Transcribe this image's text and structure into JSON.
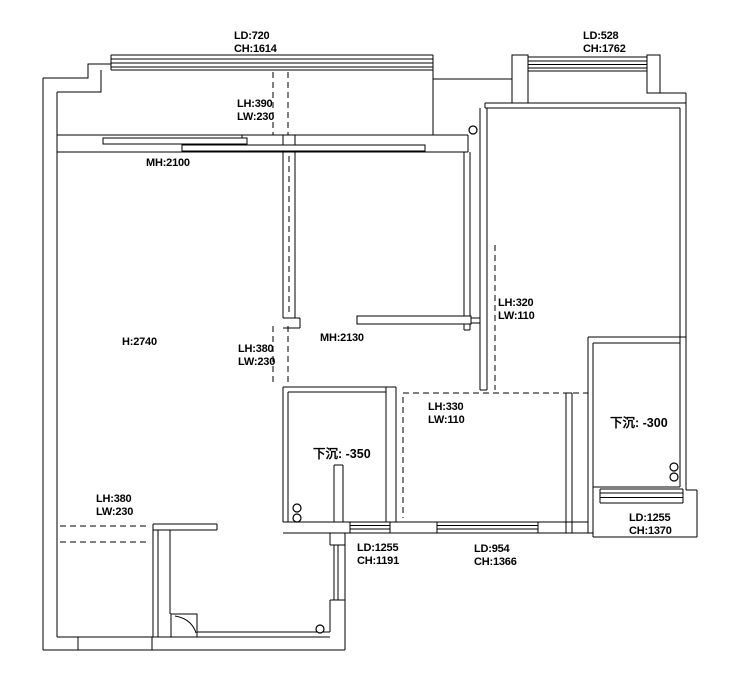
{
  "drawing": {
    "type": "floor-plan",
    "colors": {
      "line": "#000000",
      "background": "#ffffff"
    },
    "labels": {
      "top_left_window": {
        "line1": "LD:720",
        "line2": "CH:1614"
      },
      "top_right_window": {
        "line1": "LD:528",
        "line2": "CH:1762"
      },
      "balcony_beam": {
        "line1": "LH:390",
        "line2": "LW:230"
      },
      "top_door_height": {
        "line1": "MH:2100"
      },
      "ceiling_height": {
        "line1": "H:2740"
      },
      "mid_beam": {
        "line1": "LH:380",
        "line2": "LW:230"
      },
      "mid_door_height": {
        "line1": "MH:2130"
      },
      "right_beam": {
        "line1": "LH:320",
        "line2": "LW:110"
      },
      "kitchen_beam": {
        "line1": "LH:330",
        "line2": "LW:110"
      },
      "sunken_left": {
        "line1": "下沉: -350"
      },
      "sunken_right": {
        "line1": "下沉: -300"
      },
      "bottom_left_beam": {
        "line1": "LH:380",
        "line2": "LW:230"
      },
      "bottom_left_window": {
        "line1": "LD:1255",
        "line2": "CH:1191"
      },
      "bottom_mid_window": {
        "line1": "LD:954",
        "line2": "CH:1366"
      },
      "bottom_right_window": {
        "line1": "LD:1255",
        "line2": "CH:1370"
      }
    }
  }
}
